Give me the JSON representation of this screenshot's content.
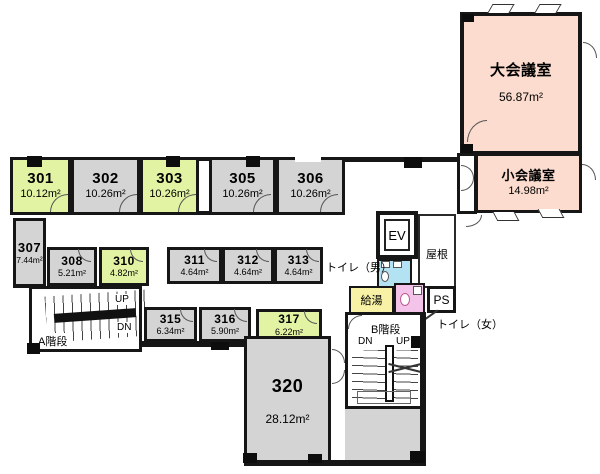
{
  "floor_plan": {
    "units_note": "areas shown in square meters",
    "colors": {
      "vacant_green": "#e2f4a3",
      "room_gray": "#d4d4d4",
      "meeting_peach": "#fbdcce",
      "hot_water_yellow": "#f7f2a5",
      "toilet_men_blue": "#b3e2f2",
      "toilet_women_pink": "#f3c3ea",
      "wall_black": "#161616"
    }
  },
  "rooms": {
    "r301": {
      "number": "301",
      "area": "10.12m²"
    },
    "r302": {
      "number": "302",
      "area": "10.26m²"
    },
    "r303": {
      "number": "303",
      "area": "10.26m²"
    },
    "r305": {
      "number": "305",
      "area": "10.26m²"
    },
    "r306": {
      "number": "306",
      "area": "10.26m²"
    },
    "r307": {
      "number": "307",
      "area": "7.44m²"
    },
    "r308": {
      "number": "308",
      "area": "5.21m²"
    },
    "r310": {
      "number": "310",
      "area": "4.82m²"
    },
    "r311": {
      "number": "311",
      "area": "4.64m²"
    },
    "r312": {
      "number": "312",
      "area": "4.64m²"
    },
    "r313": {
      "number": "313",
      "area": "4.64m²"
    },
    "r315": {
      "number": "315",
      "area": "6.34m²"
    },
    "r316": {
      "number": "316",
      "area": "5.90m²"
    },
    "r317": {
      "number": "317",
      "area": "6.22m²"
    },
    "r320": {
      "number": "320",
      "area": "28.12m²"
    }
  },
  "meeting": {
    "large": {
      "name": "大会議室",
      "area": "56.87m²"
    },
    "small": {
      "name": "小会議室",
      "area": "14.98m²"
    }
  },
  "facilities": {
    "elevator": "EV",
    "roof": "屋根",
    "pipe_shaft": "PS",
    "hot_water": "給湯",
    "toilet_men": "トイレ（男）",
    "toilet_women": "トイレ（女）"
  },
  "stairs": {
    "a": {
      "label": "A階段",
      "up": "UP",
      "dn": "DN"
    },
    "b": {
      "label": "B階段",
      "up": "UP",
      "dn": "DN"
    }
  }
}
